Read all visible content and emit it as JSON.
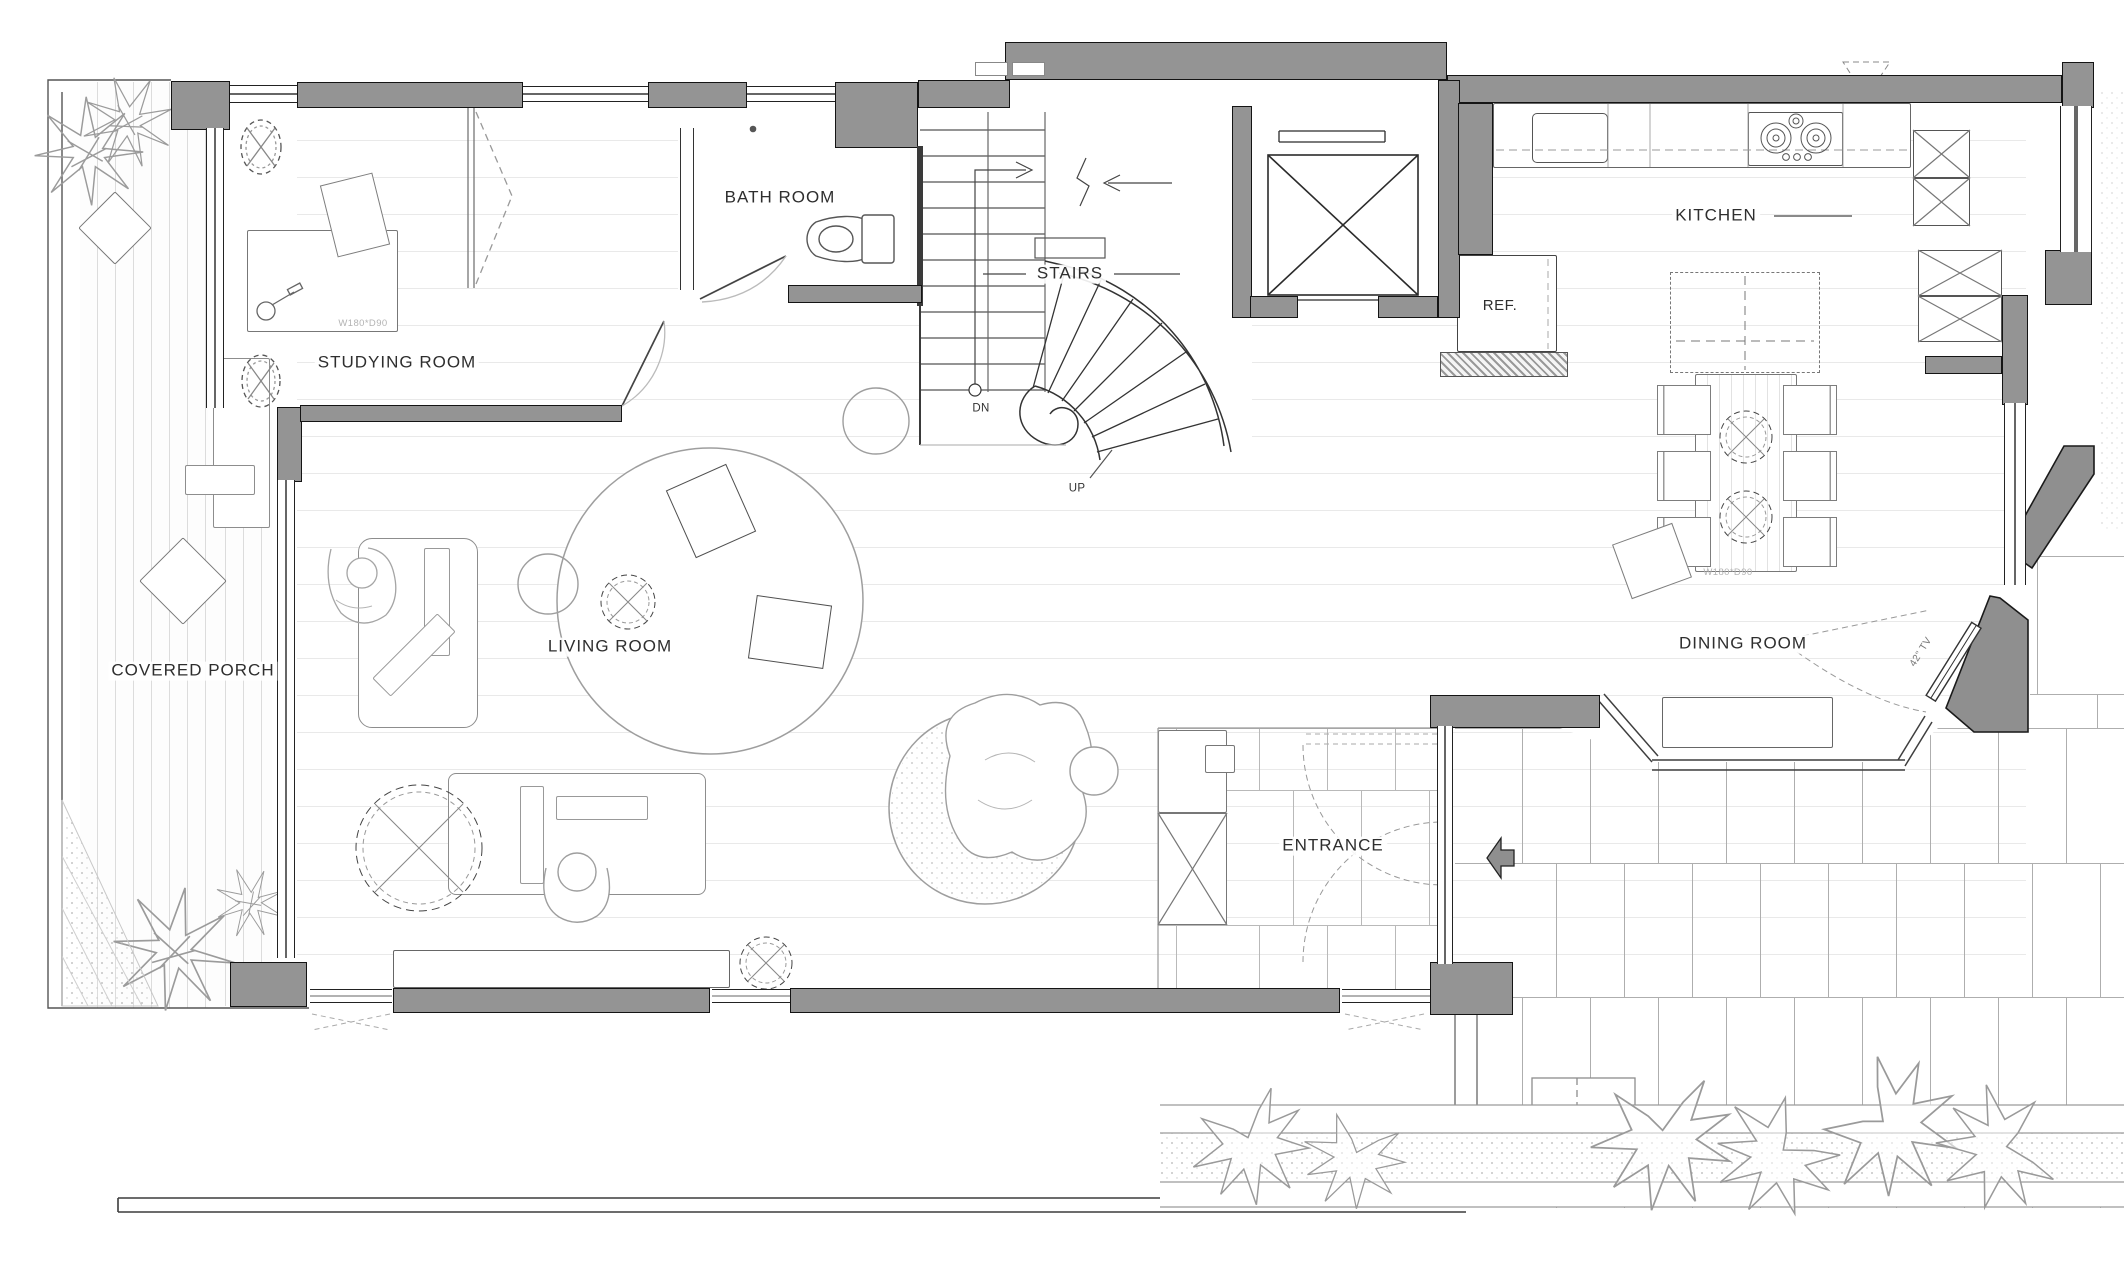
{
  "plan": {
    "rooms": {
      "covered_porch": "COVERED PORCH",
      "studying_room": "STUDYING ROOM",
      "bath_room": "BATH ROOM",
      "stairs": "STAIRS",
      "living_room": "LIVING ROOM",
      "kitchen": "KITCHEN",
      "dining_room": "DINING ROOM",
      "entrance": "ENTRANCE"
    },
    "annotations": {
      "refrigerator": "REF.",
      "stairs_down": "DN",
      "stairs_up": "UP",
      "tv": "42\" TV",
      "desk_dimension": "W180*D90",
      "dining_table_dimension": "W180*D90"
    },
    "icons": {
      "entrance_arrow": "block-arrow-left",
      "elevator": "crossed-box",
      "trees": "starburst-plan-tree",
      "flowers": "leafy-plan-shrub"
    },
    "colors": {
      "wall_fill": "#949494",
      "outline": "#141414",
      "furniture_line": "#8d8d8d",
      "floor_line": "#e9e9e9",
      "porch_line": "#dcdcdc",
      "tile_line": "#aeaeae",
      "label_text": "#2e2e2e",
      "dimension_text": "#b3b3b3"
    }
  }
}
